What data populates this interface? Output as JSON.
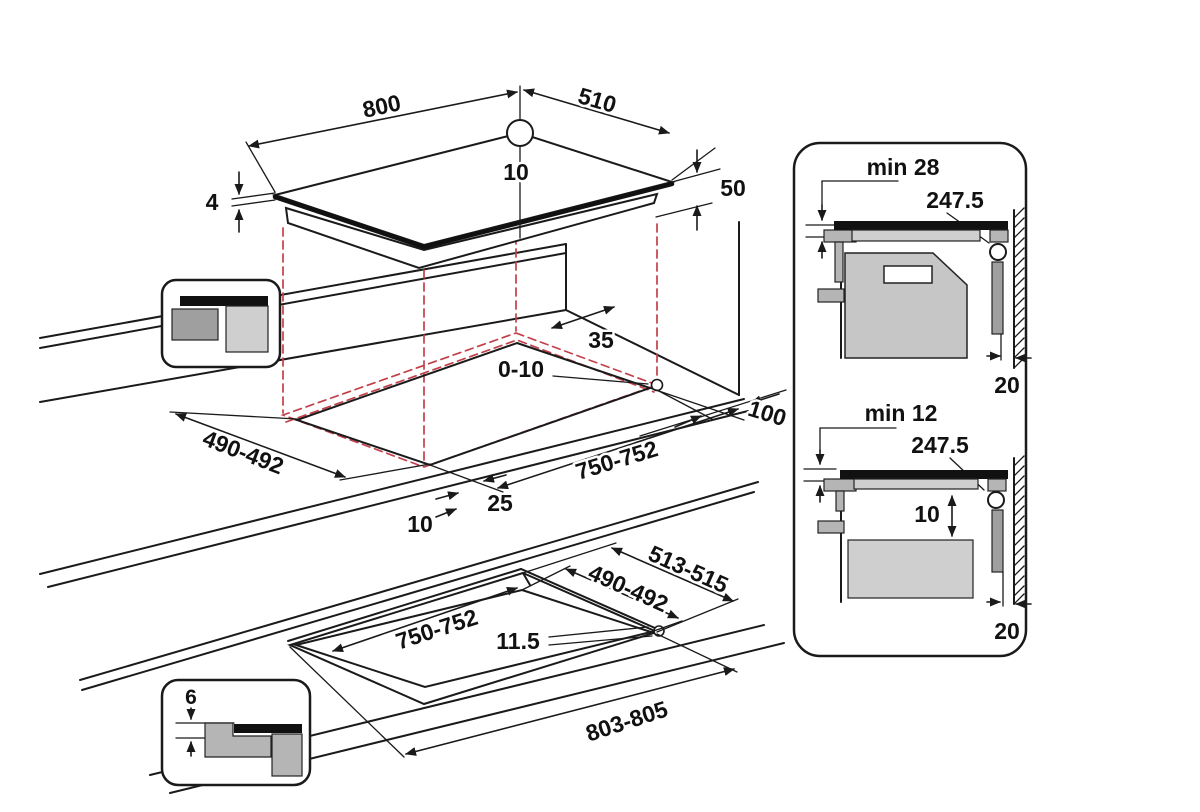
{
  "title": "Built-in hob installation dimensions diagram",
  "views": {
    "hob": {
      "width": "800",
      "depth": "510",
      "hole_offset": "10",
      "height": "50",
      "glass_thickness": "4"
    },
    "worktop_cutout": {
      "back_clearance": "35",
      "rear_gap": "0-10",
      "right_clearance": "100",
      "depth": "490-492",
      "width": "750-752",
      "front_offset": "25",
      "side_offset": "10"
    },
    "flush_cutout": {
      "outer_depth": "513-515",
      "depth": "490-492",
      "width": "750-752",
      "ledge": "11.5",
      "outer_width": "803-805"
    },
    "flush_detail": {
      "step_depth": "6"
    },
    "section_oven": {
      "min_clearance": "min 28",
      "cable": "247.5",
      "wall_gap": "20"
    },
    "section_drawer": {
      "min_clearance": "min 12",
      "cable": "247.5",
      "top_gap": "10",
      "wall_gap": "20"
    }
  },
  "colors": {
    "line": "#1a1a1a",
    "projection_red": "#c2404a",
    "oven_gray": "#c6c6c6",
    "bracket_gray": "#b5b5b5",
    "duct_gray": "#9f9f9f",
    "drawer_gray": "#cfcfcf",
    "hob_black": "#111111"
  }
}
